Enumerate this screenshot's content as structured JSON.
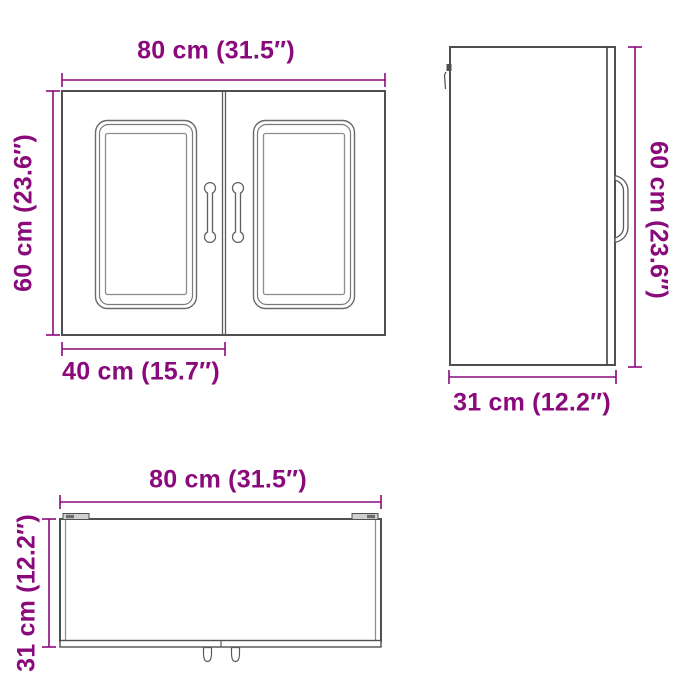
{
  "colors": {
    "dimension_accent": "#8A0A7B",
    "outline": "#4F4F4F"
  },
  "views": {
    "front": {
      "width_label": "80 cm (31.5″)",
      "height_label": "60 cm (23.6″)",
      "door_width_label": "40 cm (15.7″)"
    },
    "side": {
      "height_label": "60 cm (23.6″)",
      "depth_label": "31 cm (12.2″)"
    },
    "top": {
      "width_label": "80 cm (31.5″)",
      "depth_label": "31 cm (12.2″)"
    }
  }
}
